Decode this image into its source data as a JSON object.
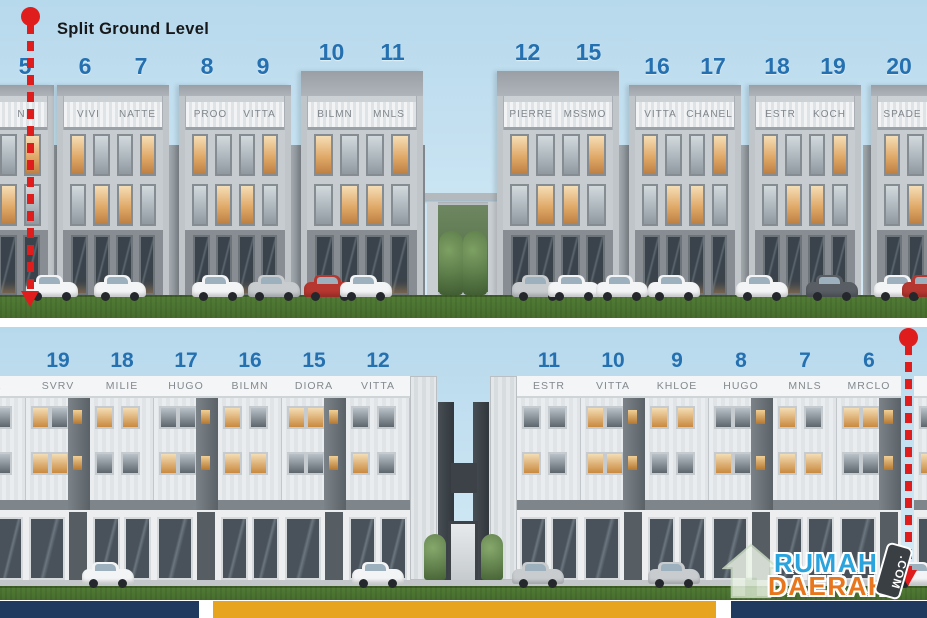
{
  "annotations": {
    "split_ground_level": "Split Ground Level"
  },
  "colors": {
    "unit_number_blue": "#2470b0",
    "annotation_red": "#e01d1d",
    "footer_navy": "#1f3a5e",
    "footer_orange": "#e7a41f",
    "logo_blue": "#2ba3dc",
    "logo_orange": "#e8761d",
    "sky": "#bedff0",
    "grass": "#4e7c35"
  },
  "watermark": {
    "word1": "RUMAH",
    "word2": "DAERAH",
    "badge": ".COM"
  },
  "top_row": {
    "edge_unit": {
      "number": "5",
      "name": "N"
    },
    "buildings": [
      {
        "units": [
          {
            "number": "6",
            "name": "VIVI"
          },
          {
            "number": "7",
            "name": "NATTE"
          }
        ]
      },
      {
        "units": [
          {
            "number": "8",
            "name": "PROO"
          },
          {
            "number": "9",
            "name": "VITTA"
          }
        ]
      },
      {
        "units": [
          {
            "number": "10",
            "name": "BILMN"
          },
          {
            "number": "11",
            "name": "MNLS"
          }
        ]
      },
      {
        "units": [
          {
            "number": "12",
            "name": "PIERRE"
          },
          {
            "number": "15",
            "name": "MSSMO"
          }
        ]
      },
      {
        "units": [
          {
            "number": "16",
            "name": "VITTA"
          },
          {
            "number": "17",
            "name": "CHANEL"
          }
        ]
      },
      {
        "units": [
          {
            "number": "18",
            "name": "ESTR"
          },
          {
            "number": "19",
            "name": "KOCH"
          }
        ]
      },
      {
        "units": [
          {
            "number": "20",
            "name": "SPADE"
          }
        ]
      }
    ]
  },
  "bottom_row": {
    "left_edge_unit": {
      "number": "0",
      "name": "TA"
    },
    "left_wing_units": [
      {
        "number": "19",
        "name": "SVRV"
      },
      {
        "number": "18",
        "name": "MILIE"
      },
      {
        "number": "17",
        "name": "HUGO"
      },
      {
        "number": "16",
        "name": "BILMN"
      },
      {
        "number": "15",
        "name": "DIORA"
      },
      {
        "number": "12",
        "name": "VITTA"
      }
    ],
    "right_wing_units": [
      {
        "number": "11",
        "name": "ESTR"
      },
      {
        "number": "10",
        "name": "VITTA"
      },
      {
        "number": "9",
        "name": "KHLOE"
      },
      {
        "number": "8",
        "name": "HUGO"
      },
      {
        "number": "7",
        "name": "MNLS"
      },
      {
        "number": "6",
        "name": "MRCLO"
      }
    ],
    "right_edge_fragment": {
      "name": "M"
    }
  }
}
